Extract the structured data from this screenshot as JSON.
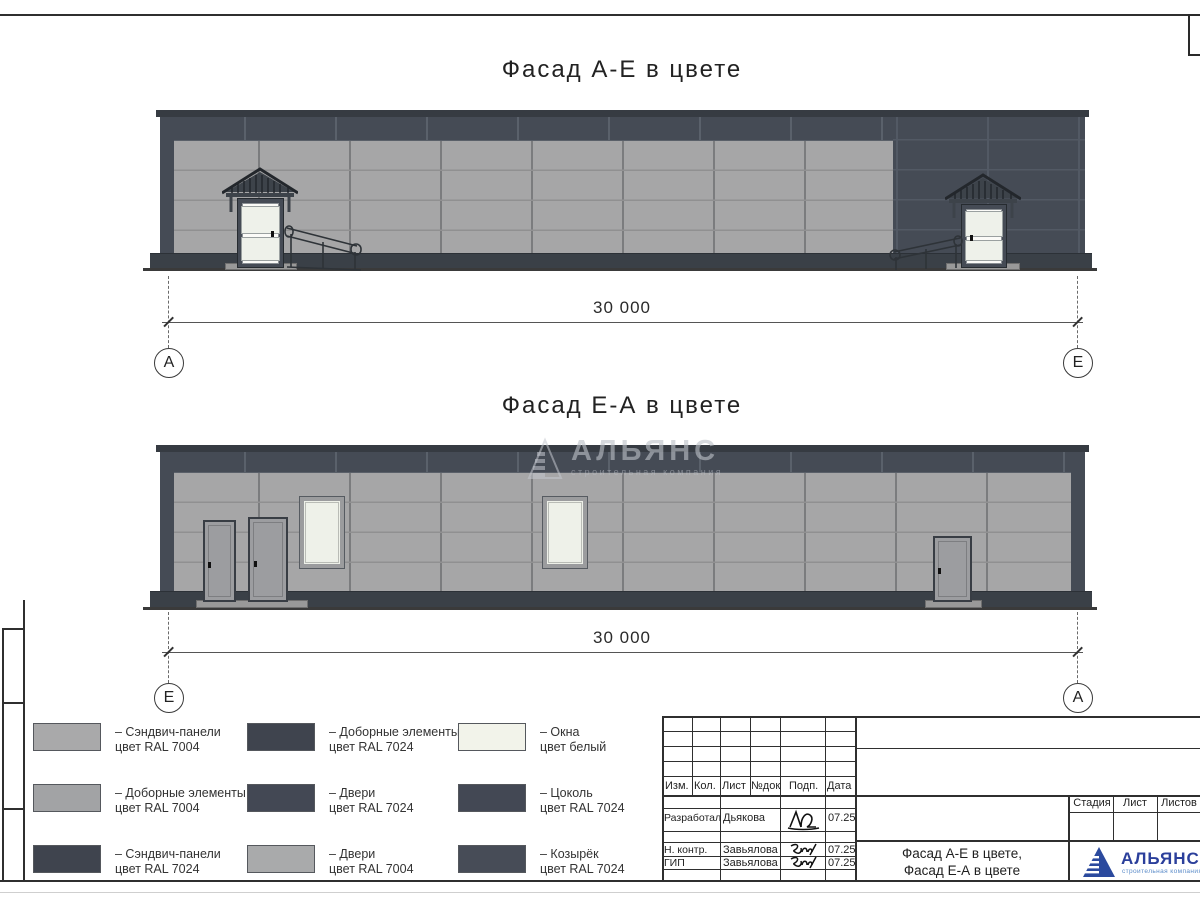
{
  "drawing": {
    "facade1": {
      "title": "Фасад А-Е в цвете",
      "dim": "30 000",
      "axis_left": "А",
      "axis_right": "Е"
    },
    "facade2": {
      "title": "Фасад Е-А в цвете",
      "dim": "30 000",
      "axis_left": "Е",
      "axis_right": "А"
    }
  },
  "watermark": {
    "name": "АЛЬЯНС",
    "subtitle": "строительная компания"
  },
  "legend": {
    "items": [
      {
        "color": "#a9a9aa",
        "line1": "– Сэндвич-панели",
        "line2": "цвет RAL 7004"
      },
      {
        "color": "#a2a3a5",
        "line1": "– Доборные элементы",
        "line2": "цвет RAL 7004"
      },
      {
        "color": "#3f444e",
        "line1": "– Сэндвич-панели",
        "line2": "цвет RAL 7024"
      },
      {
        "color": "#3f444e",
        "line1": "– Доборные элементы",
        "line2": "цвет RAL 7024"
      },
      {
        "color": "#434854",
        "line1": "– Двери",
        "line2": "цвет RAL 7024"
      },
      {
        "color": "#a9aaab",
        "line1": "– Двери",
        "line2": "цвет RAL 7004"
      },
      {
        "color": "#f2f3ea",
        "line1": "– Окна",
        "line2": "цвет белый"
      },
      {
        "color": "#434854",
        "line1": "– Цоколь",
        "line2": "цвет RAL 7024"
      },
      {
        "color": "#474c57",
        "line1": "– Козырёк",
        "line2": "цвет RAL 7024"
      }
    ]
  },
  "titleblock": {
    "header_cols": [
      "Изм.",
      "Кол.",
      "Лист",
      "№док",
      "Подп.",
      "Дата"
    ],
    "rows": [
      {
        "role": "Разработал",
        "name": "Дьякова",
        "date": "07.25"
      },
      {
        "role": "Н. контр.",
        "name": "Завьялова",
        "date": "07.25"
      },
      {
        "role": "ГИП",
        "name": "Завьялова",
        "date": "07.25"
      }
    ],
    "stage_cols": [
      "Стадия",
      "Лист",
      "Листов"
    ],
    "doc_name_line1": "Фасад А-Е в цвете,",
    "doc_name_line2": "Фасад Е-А в цвете",
    "logo_name": "АЛЬЯНС",
    "logo_subtitle": "строительная компания"
  },
  "colors": {
    "ral7004": "#a5a5a6",
    "ral7024": "#454b55",
    "window_white": "#eef1e9",
    "logo_blue": "#2b3f9b",
    "logo_light_blue": "#5c8cc9"
  }
}
